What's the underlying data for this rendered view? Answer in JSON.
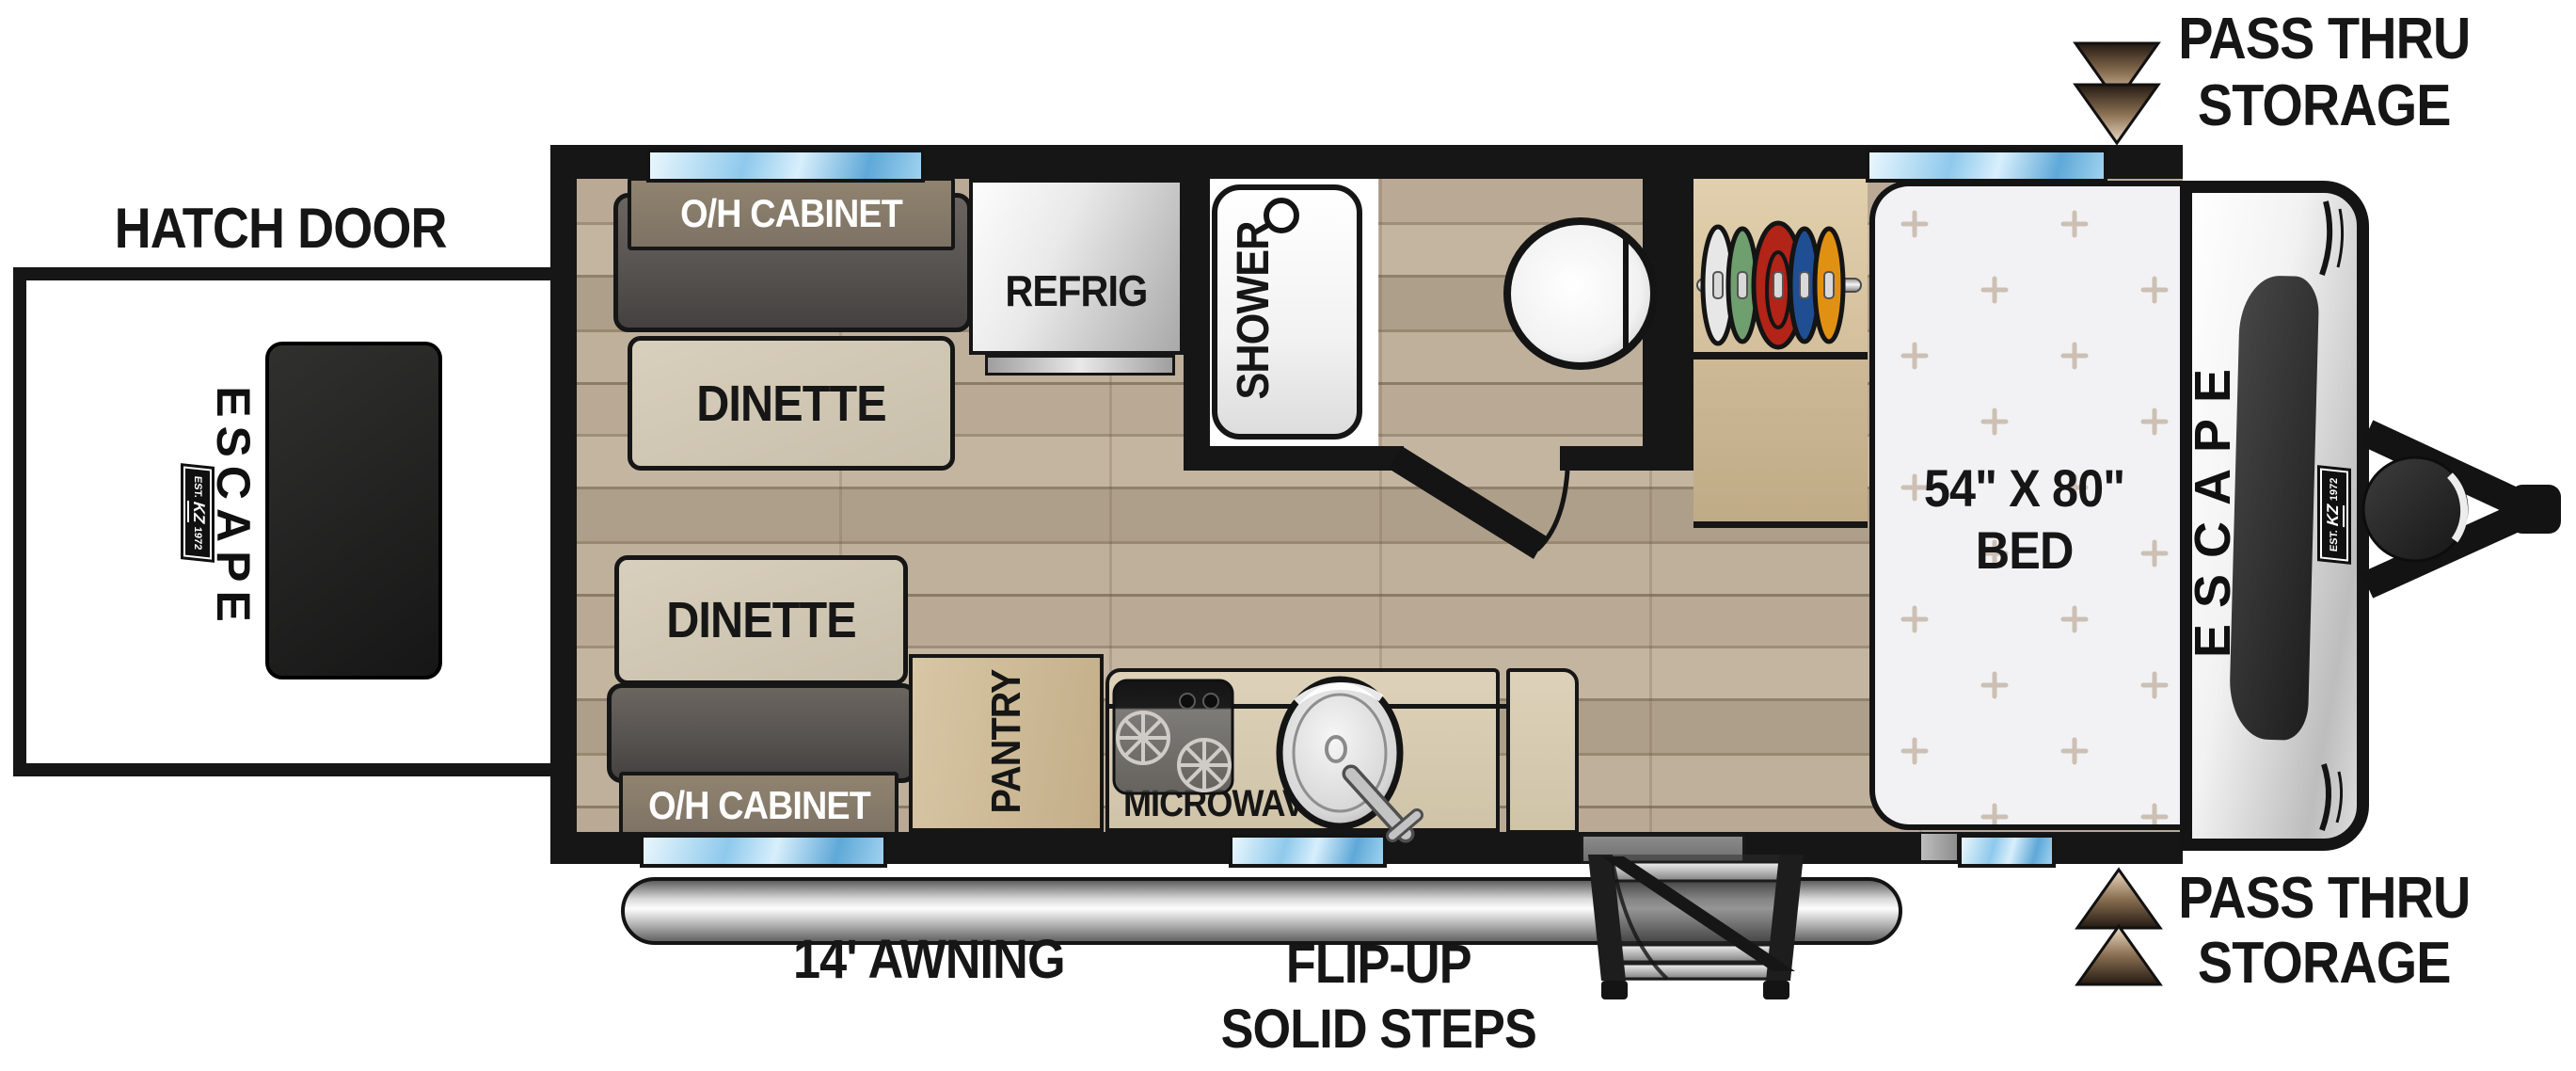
{
  "labels": {
    "hatch_door": "HATCH DOOR",
    "pass_thru_top": {
      "line1": "PASS THRU",
      "line2": "STORAGE"
    },
    "pass_thru_bottom": {
      "line1": "PASS THRU",
      "line2": "STORAGE"
    },
    "awning": "14' AWNING",
    "steps": {
      "line1": "FLIP-UP",
      "line2": "SOLID STEPS"
    }
  },
  "furniture": {
    "oh_cabinet_top": "O/H CABINET",
    "oh_cabinet_bottom": "O/H CABINET",
    "dinette_top": "DINETTE",
    "dinette_bottom": "DINETTE",
    "refrig": "REFRIG",
    "shower": "SHOWER",
    "pantry": "PANTRY",
    "microwave": "MICROWAVE",
    "bed": {
      "size": "54\" X 80\"",
      "label": "BED"
    }
  },
  "branding": {
    "model": "ESCAPE",
    "badge": {
      "est": "EST.",
      "maker": "KZ",
      "year": "1972"
    }
  },
  "colors": {
    "wall_black": "#161616",
    "window_blue": "#7fc0e8",
    "floor_wood": "#b4a593",
    "bed_white": "#f2f2f4",
    "cabinet_brown": "#897c6f",
    "bench_gray": "#575350",
    "dinette_tan": "#d0c7b3",
    "counter_tan": "#d8cdb4",
    "closet_tan": "#dcc9a6",
    "arrow_tan": "#ecd9c0",
    "hanger_colors": [
      "#e7e7e7",
      "#6f9f6e",
      "#b22318",
      "#1f4e92",
      "#e19112"
    ]
  }
}
